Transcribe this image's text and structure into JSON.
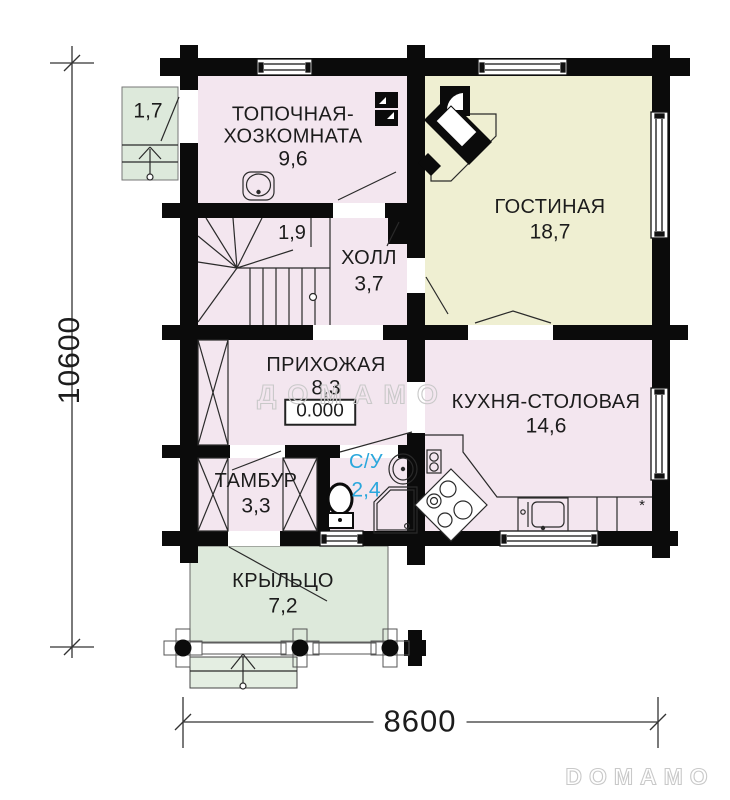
{
  "rooms": {
    "topochnaya": {
      "name": "ТОПОЧНАЯ-ХОЗКОМНАТА",
      "area": "9,6"
    },
    "gostinaya": {
      "name": "ГОСТИНАЯ",
      "area": "18,7"
    },
    "holl": {
      "name": "ХОЛЛ",
      "area": "3,7"
    },
    "understair": {
      "area": "1,9"
    },
    "prihozhaya": {
      "name": "ПРИХОЖАЯ",
      "area": "8,3"
    },
    "kuhnya": {
      "name": "КУХНЯ-СТОЛОВАЯ",
      "area": "14,6"
    },
    "tambur": {
      "name": "ТАМБУР",
      "area": "3,3"
    },
    "su": {
      "name": "С/У",
      "area": "2,4"
    },
    "kryltso": {
      "name": "КРЫЛЬЦО",
      "area": "7,2"
    },
    "balkon": {
      "area": "1,7"
    }
  },
  "annotations": {
    "elevation_mark": "0.000",
    "kitchen_marker": "*"
  },
  "dimensions": {
    "overall_height_mm": "10600",
    "overall_width_mm": "8600"
  },
  "watermarks": {
    "center": "ДОМАМО",
    "bottom_right": "DOMAMO"
  },
  "colors": {
    "room_pink": "#F3E6EF",
    "room_yellow": "#EFEFD2",
    "room_green": "#DDE9DB",
    "wall_black": "#0B0B0B",
    "su_label_blue": "#2AA7DC",
    "watermark_gray": "#C9C9C9"
  }
}
